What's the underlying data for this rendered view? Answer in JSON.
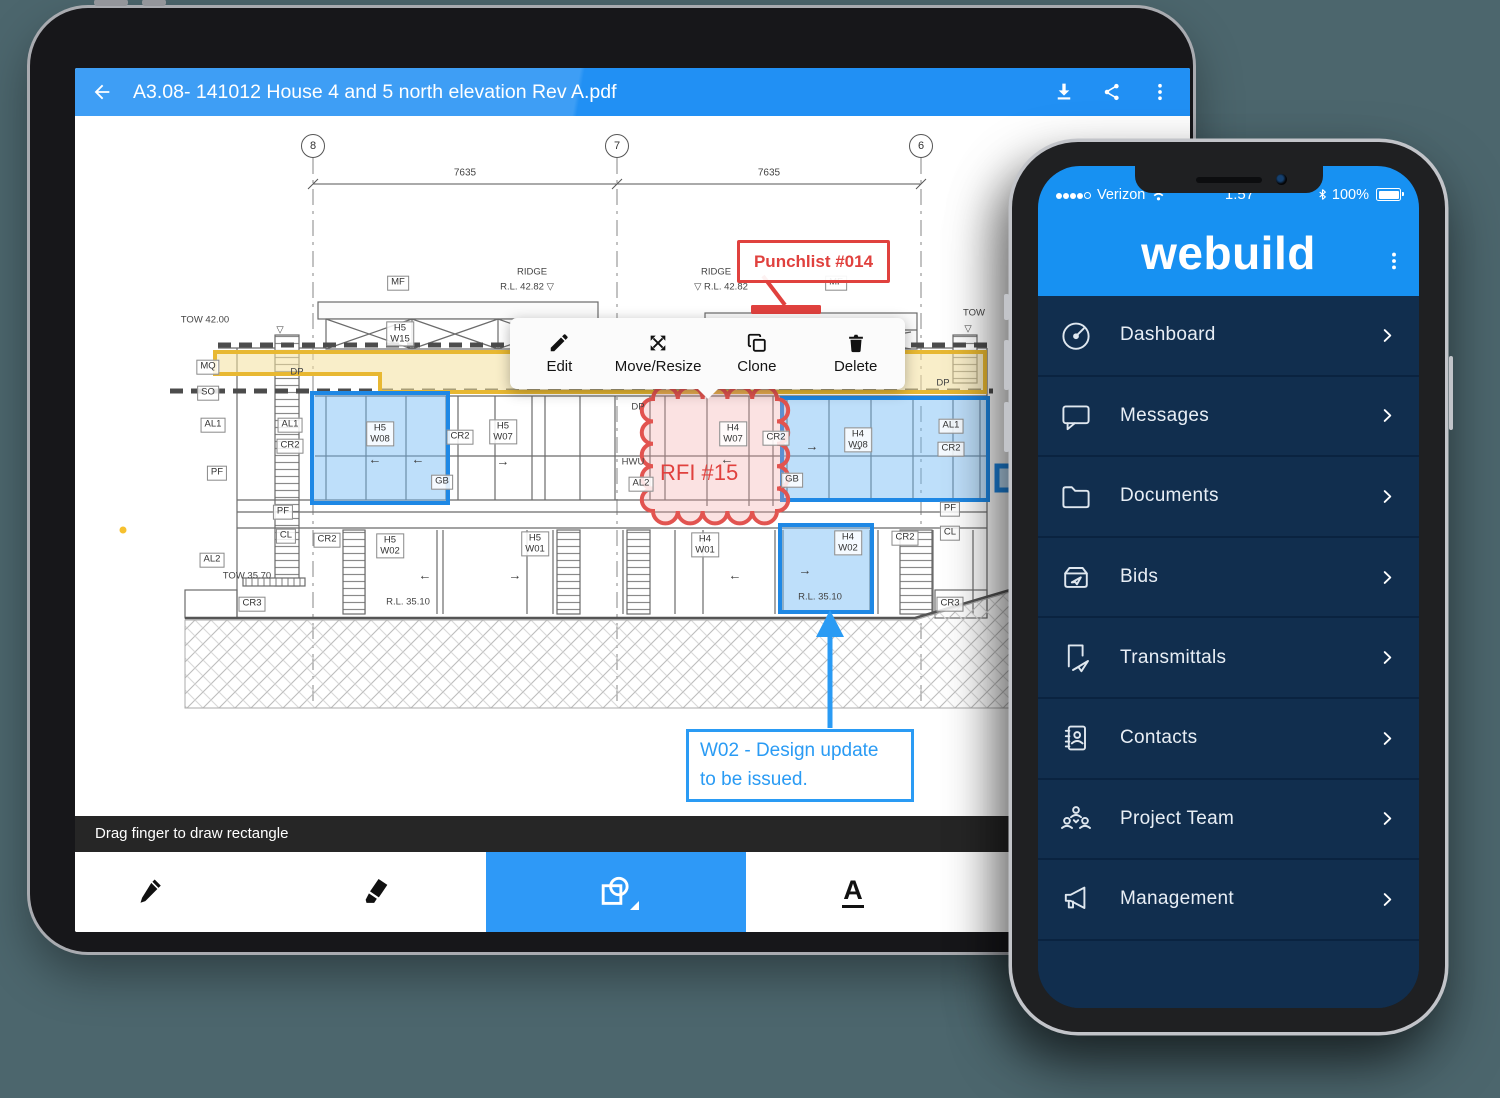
{
  "scene": {
    "background": "#4c666d"
  },
  "tablet": {
    "header": {
      "title": "A3.08- 141012 House 4 and 5 north elevation Rev A.pdf",
      "color": "#2190f4",
      "icons": [
        "back-arrow",
        "download",
        "share",
        "overflow-menu"
      ]
    },
    "context_menu": {
      "items": [
        {
          "icon": "pencil",
          "label": "Edit"
        },
        {
          "icon": "move-resize",
          "label": "Move/Resize"
        },
        {
          "icon": "clone",
          "label": "Clone"
        },
        {
          "icon": "delete",
          "label": "Delete"
        }
      ]
    },
    "hint_bar": {
      "text": "Drag finger to draw rectangle"
    },
    "toolbar": {
      "tools": [
        "pen",
        "highlighter",
        "shape",
        "text"
      ],
      "selected_tool": "shape",
      "selected_color": "#2e99f7"
    },
    "blueprint": {
      "grid_bubbles": [
        {
          "n": "8",
          "x": 238,
          "y": 30
        },
        {
          "n": "7",
          "x": 542,
          "y": 30
        },
        {
          "n": "6",
          "x": 846,
          "y": 30
        }
      ],
      "dimensions": [
        {
          "t": "7635",
          "x": 390,
          "y": 57
        },
        {
          "t": "7635",
          "x": 694,
          "y": 57
        }
      ],
      "labels": [
        {
          "t": "MF",
          "x": 323,
          "y": 167,
          "k": "box"
        },
        {
          "t": "MF",
          "x": 761,
          "y": 167,
          "k": "box"
        },
        {
          "t": "RIDGE",
          "x": 457,
          "y": 157,
          "k": "plain"
        },
        {
          "t": "R.L. 42.82 ▽",
          "x": 452,
          "y": 172,
          "k": "plain"
        },
        {
          "t": "RIDGE",
          "x": 641,
          "y": 157,
          "k": "plain"
        },
        {
          "t": "▽ R.L. 42.82",
          "x": 646,
          "y": 172,
          "k": "plain"
        },
        {
          "t": "TOW 42.00",
          "x": 130,
          "y": 205,
          "k": "plain"
        },
        {
          "t": "▽",
          "x": 205,
          "y": 215,
          "k": "plain"
        },
        {
          "t": "TOW",
          "x": 899,
          "y": 198,
          "k": "plain"
        },
        {
          "t": "▽",
          "x": 893,
          "y": 214,
          "k": "plain"
        },
        {
          "t": "H5|W15",
          "x": 325,
          "y": 218,
          "k": "box"
        },
        {
          "t": "MQ",
          "x": 133,
          "y": 251,
          "k": "box"
        },
        {
          "t": "SO",
          "x": 133,
          "y": 277,
          "k": "box"
        },
        {
          "t": "DP",
          "x": 222,
          "y": 257,
          "k": "plain"
        },
        {
          "t": "DP",
          "x": 563,
          "y": 292,
          "k": "plain"
        },
        {
          "t": "DP",
          "x": 868,
          "y": 268,
          "k": "plain"
        },
        {
          "t": "AL1",
          "x": 138,
          "y": 309,
          "k": "box"
        },
        {
          "t": "AL1",
          "x": 215,
          "y": 309,
          "k": "box"
        },
        {
          "t": "CR2",
          "x": 215,
          "y": 330,
          "k": "box"
        },
        {
          "t": "PF",
          "x": 142,
          "y": 357,
          "k": "box"
        },
        {
          "t": "AL2",
          "x": 137,
          "y": 444,
          "k": "box"
        },
        {
          "t": "H5|W08",
          "x": 305,
          "y": 318,
          "k": "box"
        },
        {
          "t": "←",
          "x": 300,
          "y": 344,
          "k": "arrow"
        },
        {
          "t": "←",
          "x": 343,
          "y": 344,
          "k": "arrow"
        },
        {
          "t": "GB",
          "x": 367,
          "y": 366,
          "k": "box"
        },
        {
          "t": "CR2",
          "x": 385,
          "y": 321,
          "k": "box"
        },
        {
          "t": "H5|W07",
          "x": 428,
          "y": 316,
          "k": "box"
        },
        {
          "t": "→",
          "x": 428,
          "y": 346,
          "k": "arrow"
        },
        {
          "t": "HWU",
          "x": 558,
          "y": 347,
          "k": "plain"
        },
        {
          "t": "AL2",
          "x": 566,
          "y": 368,
          "k": "box"
        },
        {
          "t": "H4|W07",
          "x": 658,
          "y": 318,
          "k": "box"
        },
        {
          "t": "←",
          "x": 652,
          "y": 344,
          "k": "arrow"
        },
        {
          "t": "CR2",
          "x": 701,
          "y": 322,
          "k": "box"
        },
        {
          "t": "H4|W08",
          "x": 783,
          "y": 324,
          "k": "box"
        },
        {
          "t": "→",
          "x": 737,
          "y": 331,
          "k": "arrow"
        },
        {
          "t": "→",
          "x": 782,
          "y": 331,
          "k": "arrow"
        },
        {
          "t": "AL1",
          "x": 876,
          "y": 310,
          "k": "box"
        },
        {
          "t": "CR2",
          "x": 876,
          "y": 333,
          "k": "box"
        },
        {
          "t": "GB",
          "x": 717,
          "y": 364,
          "k": "box"
        },
        {
          "t": "PF",
          "x": 208,
          "y": 396,
          "k": "box"
        },
        {
          "t": "CL",
          "x": 211,
          "y": 420,
          "k": "box"
        },
        {
          "t": "PF",
          "x": 875,
          "y": 393,
          "k": "box"
        },
        {
          "t": "CL",
          "x": 875,
          "y": 417,
          "k": "box"
        },
        {
          "t": "CR2",
          "x": 252,
          "y": 424,
          "k": "box"
        },
        {
          "t": "H5|W02",
          "x": 315,
          "y": 430,
          "k": "box"
        },
        {
          "t": "←",
          "x": 350,
          "y": 460,
          "k": "arrow"
        },
        {
          "t": "R.L. 35.10",
          "x": 333,
          "y": 487,
          "k": "plain"
        },
        {
          "t": "→",
          "x": 440,
          "y": 460,
          "k": "arrow"
        },
        {
          "t": "H5|W01",
          "x": 460,
          "y": 428,
          "k": "box"
        },
        {
          "t": "H4|W01",
          "x": 630,
          "y": 429,
          "k": "box"
        },
        {
          "t": "←",
          "x": 660,
          "y": 460,
          "k": "arrow"
        },
        {
          "t": "H4|W02",
          "x": 773,
          "y": 427,
          "k": "box"
        },
        {
          "t": "→",
          "x": 730,
          "y": 455,
          "k": "arrow"
        },
        {
          "t": "R.L. 35.10",
          "x": 745,
          "y": 482,
          "k": "plain"
        },
        {
          "t": "CR2",
          "x": 830,
          "y": 422,
          "k": "box"
        },
        {
          "t": "TOW 35.70",
          "x": 172,
          "y": 461,
          "k": "plain"
        },
        {
          "t": "CR3",
          "x": 177,
          "y": 488,
          "k": "box"
        },
        {
          "t": "CR3",
          "x": 875,
          "y": 488,
          "k": "box"
        }
      ],
      "annotations": {
        "punchlist": {
          "text": "Punchlist #014",
          "color": "#e0413e"
        },
        "rfi": {
          "text": "RFI #15",
          "color": "#e0413e"
        },
        "callout": {
          "line1": "W02 - Design update",
          "line2": "to be issued.",
          "color": "#2a9bf4"
        },
        "highlight_blue": "#1e88e5",
        "highlight_yellow": "#e8b832"
      }
    }
  },
  "phone": {
    "status_bar": {
      "carrier": "Verizon",
      "signal": "4 of 5",
      "time": "1:57",
      "battery": "100%"
    },
    "header": {
      "logo": "webuild",
      "color": "#1791f2",
      "menu_icon": "overflow-menu"
    },
    "menu": {
      "bg": "#112e4e",
      "items": [
        {
          "icon": "dashboard",
          "label": "Dashboard"
        },
        {
          "icon": "messages",
          "label": "Messages"
        },
        {
          "icon": "documents",
          "label": "Documents"
        },
        {
          "icon": "bids",
          "label": "Bids"
        },
        {
          "icon": "transmittals",
          "label": "Transmittals"
        },
        {
          "icon": "contacts",
          "label": "Contacts"
        },
        {
          "icon": "project-team",
          "label": "Project Team"
        },
        {
          "icon": "management",
          "label": "Management"
        }
      ]
    }
  }
}
